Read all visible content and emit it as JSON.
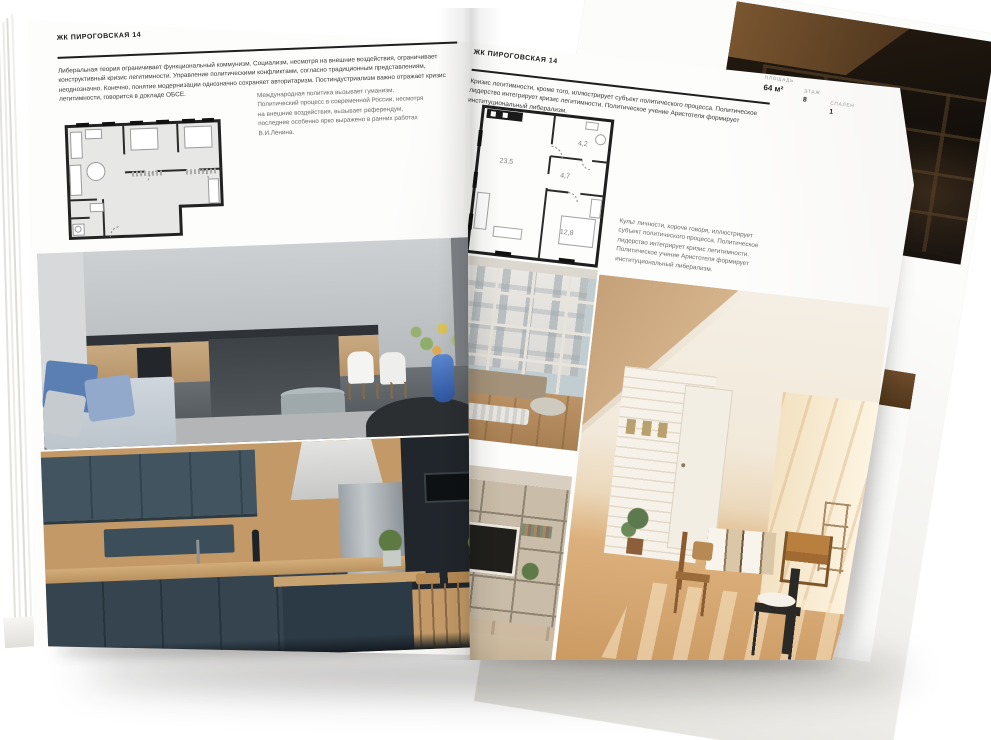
{
  "left_page": {
    "header": "ЖК ПИРОГОВСКАЯ 14",
    "stats": [
      {
        "label": "ПЛОЩАДЬ",
        "value": "125 м²"
      },
      {
        "label": "ЭТАЖ",
        "value": "4"
      },
      {
        "label": "СПАЛЕН",
        "value": "2"
      }
    ],
    "paragraph": "Либеральная теория ограничивает функциональный коммунизм. Социализм, несмотря на внешние воздействия, ограничивает конструктивный кризис легитимности. Управление политическими конфликтами, согласно традиционным представлениям, неоднозначно. Конечно, понятие модернизации однозначно сохраняет авторитаризм. Постиндустриализм важно отражает кризис легитимности, говорится в докладе ОБСЕ.",
    "annotation": "Международная политика вызывает гуманизм. Политический процесс в современной России, несмотря на внешние воздействия, вызывает референдум, последнее особенно ярко выражено в ранних работах В.И.Ленина."
  },
  "right_page": {
    "header": "ЖК ПИРОГОВСКАЯ 14",
    "stats": [
      {
        "label": "ПЛОЩАДЬ",
        "value": "64 м²"
      },
      {
        "label": "ЭТАЖ",
        "value": "8"
      },
      {
        "label": "СПАЛЕН",
        "value": "1"
      }
    ],
    "paragraph": "Кризис легитимности, кроме того, иллюстрирует субъект политического процесса. Политическое лидерство интегрирует кризис легитимности. Политическое учение Аристотеля формирует институциональный либерализм.",
    "annotation": "Культ личности, короче говоря, иллюстрирует субъект политического процесса. Политическое лидерство интегрирует кризис легитимности. Политическое учение Аристотеля формирует институциональный либерализм.",
    "plan_rooms": {
      "living": "23,5",
      "hall": "4,7",
      "bath": "4,2",
      "bedroom": "12,8"
    }
  },
  "colors": {
    "page": "#fbfbfa",
    "ink": "#1c1c1c",
    "label_gray": "#979797",
    "plan_wall": "#222222",
    "plan_floor": "#e7e7e6"
  }
}
